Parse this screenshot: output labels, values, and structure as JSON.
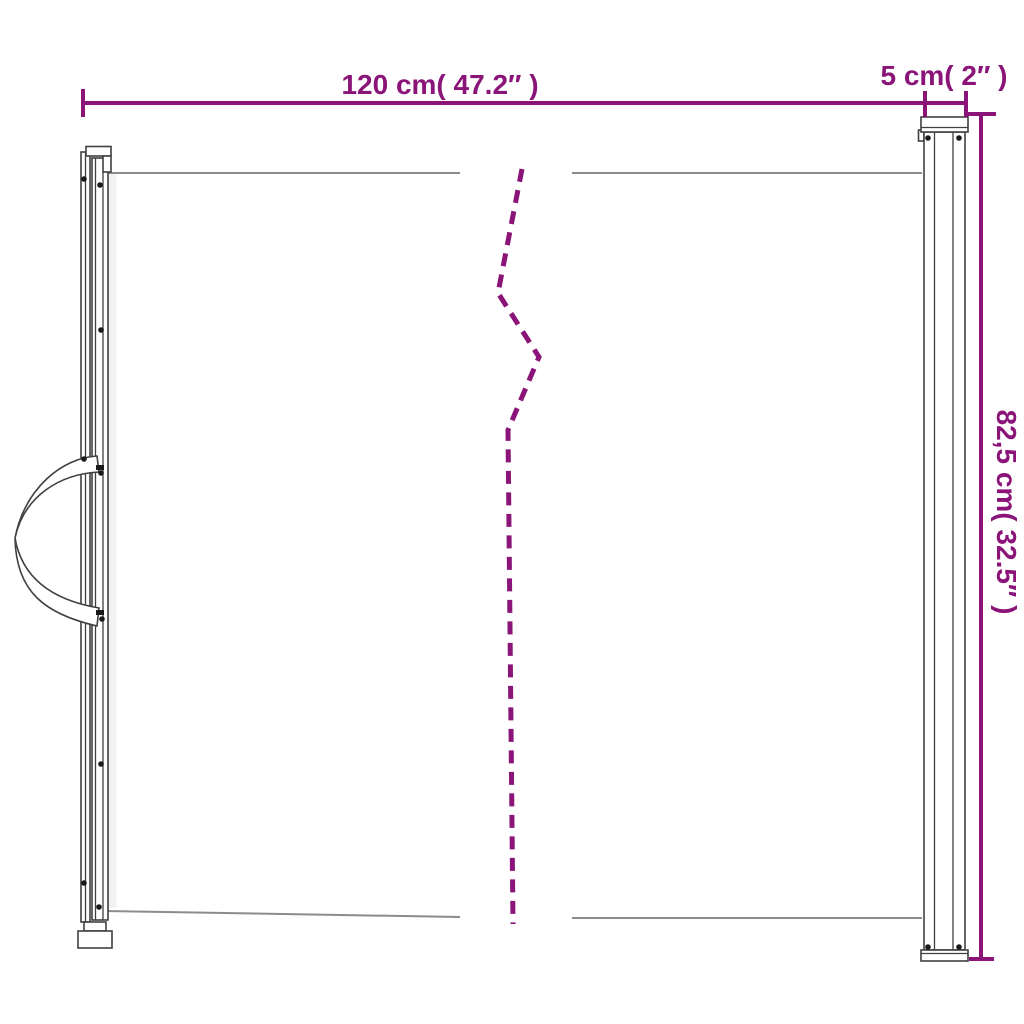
{
  "diagram": {
    "title": "retractable-gate-dimension-diagram",
    "dimensions": {
      "total_width": {
        "label": "120 cm( 47.2″ )"
      },
      "post_depth": {
        "label": "5 cm( 2″ )"
      },
      "height": {
        "label": "82,5 cm( 32.5″ )"
      }
    }
  },
  "colors": {
    "accent": "#8A1478",
    "mesh-line": "#8C8C8C",
    "outline": "#404040"
  }
}
